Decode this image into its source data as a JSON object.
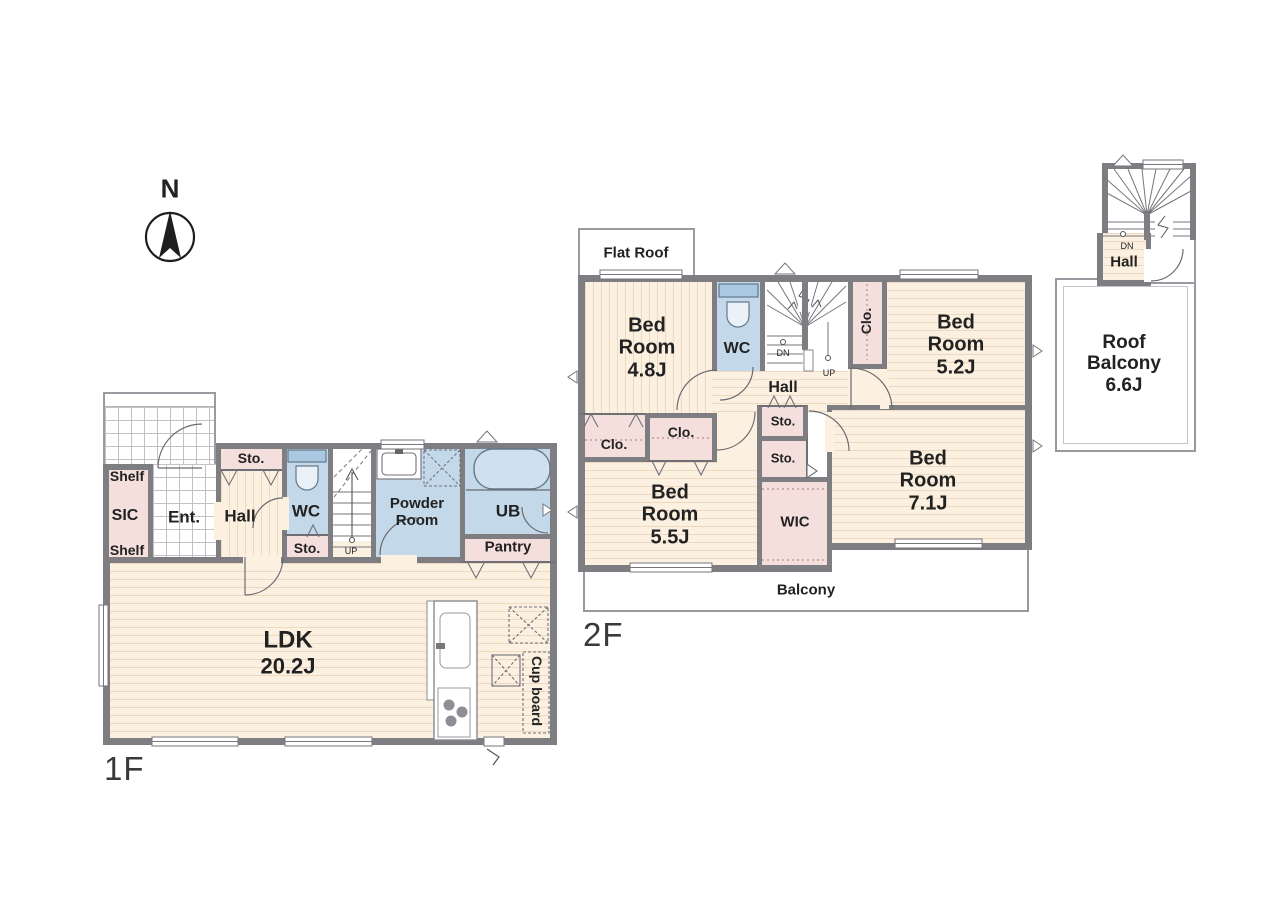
{
  "palette": {
    "wall": "#7d7d82",
    "floor_cream": "#fcf1e1",
    "closet_pink": "#f5dfdc",
    "wet_blue": "#c3d9e9",
    "line": "#6a6a70",
    "text": "#222222"
  },
  "compass": {
    "north": "N"
  },
  "f1": {
    "floor_label": "1F",
    "shelf_top": "Shelf",
    "sic": "SIC",
    "shelf_bottom": "Shelf",
    "ent": "Ent.",
    "hall": "Hall",
    "sto_hall": "Sto.",
    "wc": "WC",
    "sto_wc": "Sto.",
    "up": "UP",
    "powder": [
      "Powder",
      "Room"
    ],
    "ub": "UB",
    "pantry": "Pantry",
    "ldk": [
      "LDK",
      "20.2J"
    ],
    "cupboard": "Cup board"
  },
  "f2": {
    "floor_label": "2F",
    "flat_roof": "Flat Roof",
    "bed48": [
      "Bed",
      "Room",
      "4.8J"
    ],
    "wc": "WC",
    "dn": "DN",
    "up": "UP",
    "clo_stair": "Clo.",
    "bed52": [
      "Bed",
      "Room",
      "5.2J"
    ],
    "hall": "Hall",
    "sto_a": "Sto.",
    "sto_b": "Sto.",
    "clo_a": "Clo.",
    "clo_b": "Clo.",
    "bed55": [
      "Bed",
      "Room",
      "5.5J"
    ],
    "wic": "WIC",
    "bed71": [
      "Bed",
      "Room",
      "7.1J"
    ],
    "balcony": "Balcony"
  },
  "roof": {
    "dn": "DN",
    "hall": "Hall",
    "balcony": [
      "Roof",
      "Balcony",
      "6.6J"
    ]
  }
}
